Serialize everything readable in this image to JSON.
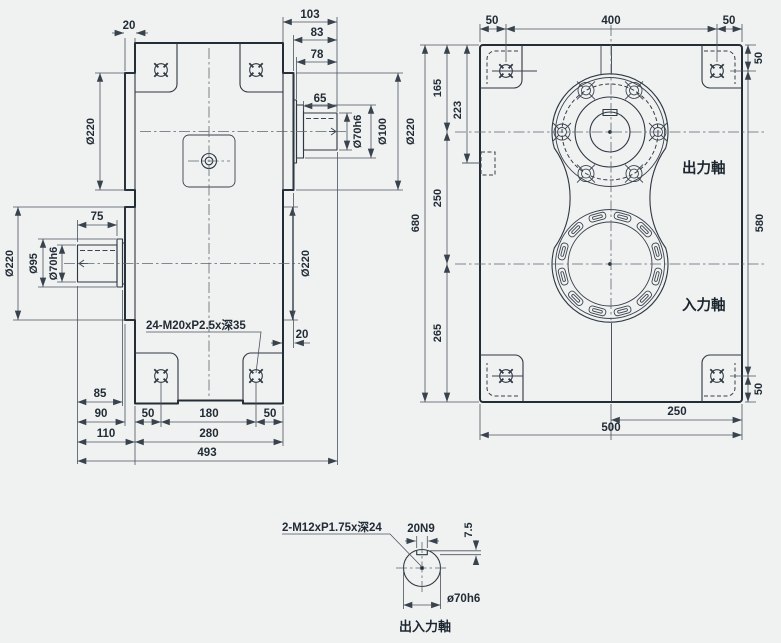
{
  "drawing_title": "gearbox-three-view-dimension-drawing",
  "colors": {
    "background": "#f0f1f1",
    "body_green_dark": "#9cb6a9",
    "body_green_light": "#d5e3d8",
    "shine": "#ffffff",
    "metal_dark": "#8d969d",
    "metal_light": "#f3f5f6",
    "line": "#232d36",
    "dim_line": "#4a545e",
    "text": "#222c36"
  },
  "side_view": {
    "top": {
      "offset": "20",
      "len_total": "103",
      "len_83": "83",
      "len_78": "78",
      "len_65": "65"
    },
    "right": {
      "shaft_dia": "Ø70h6",
      "collar_dia": "Ø100",
      "boss_dia": "Ø220",
      "boss_lower_dia": "Ø220",
      "offset": "20"
    },
    "left": {
      "boss_upper_dia": "Ø220",
      "shaft_len": "75",
      "boss_lower_dia": "Ø220",
      "collar_dia": "Ø95",
      "shaft_dia": "Ø70h6"
    },
    "bolt_note": "24-M20xP2.5x深35",
    "bottom": {
      "r85": "85",
      "r90": "90",
      "r110": "110",
      "r50a": "50",
      "r180": "180",
      "r50b": "50",
      "r280": "280",
      "r493": "493"
    }
  },
  "front_view": {
    "top": {
      "a": "50",
      "b": "400",
      "c": "50"
    },
    "right": {
      "a": "50",
      "b": "580",
      "c": "50"
    },
    "left": {
      "h165": "165",
      "h223": "223",
      "h250": "250",
      "h265": "265",
      "h680": "680"
    },
    "bottom": {
      "a": "250",
      "b": "500"
    },
    "labels": {
      "output_shaft": "出力軸",
      "input_shaft": "入力軸"
    }
  },
  "detail_view": {
    "thread_note": "2-M12xP1.75x深24",
    "keyway_width": "20N9",
    "keyway_depth": "7.5",
    "shaft_dia": "ø70h6",
    "caption": "出入力軸"
  }
}
